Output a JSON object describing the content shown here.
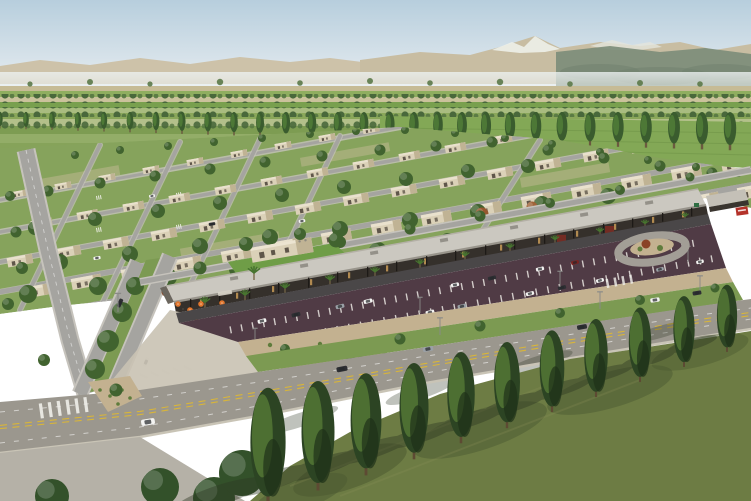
{
  "scene": {
    "type": "aerial-architectural-rendering",
    "description": "Aerial rendering of a master-planned desert community: rows of single-story beige homes with lawns and trees, a retail strip with flat canopy roof, orange cafe umbrellas and palm trees, an angled parking lot, a tree-lined boulevard, farmland strips, a poplar windbreak and mountains under a pale blue sky.",
    "regions": [
      "sky",
      "mountains",
      "farmland",
      "windbreak-poplars",
      "residential-area",
      "west-avenue",
      "retail-strip",
      "dining-plaza",
      "parking-lot",
      "landscape-median",
      "main-boulevard",
      "roundabout-island",
      "foreground-grass",
      "foreground-trees"
    ],
    "approximate_counts": {
      "houses": 62,
      "parked_cars": 19,
      "moving_cars": 10,
      "foreground_trees": 11,
      "windbreak_poplars": 29,
      "plaza_umbrellas": 6,
      "storefront_palms": 12
    }
  },
  "palette": {
    "skyTop": "#b7cedd",
    "skyHorizon": "#e9eef1",
    "mountain": "#cdc2a9",
    "mountainSnow": "#edefe9",
    "mountainRidge": "#7d8d7a",
    "fieldTan": "#c6bb95",
    "fieldGreen": "#8fae5f",
    "lawn": "#86a35c",
    "treeGreen": "#41632f",
    "treeHighlight": "#567b36",
    "poplarGreen": "#3a5c2e",
    "house": "#dbd1b8",
    "houseShade": "#c0b394",
    "houseDetail": "#5f564a",
    "road": "#a5a4a0",
    "roadCasing": "#c6c3bc",
    "boulevard": "#9b978e",
    "parkingLot": "#503b45",
    "asphalt": "#4a4748",
    "canopyRoof": "#cbc8c0",
    "storefront": "#35302b",
    "storefrontGlow": "#c79a57",
    "umbrella": "#e0762e",
    "medianGrass": "#7c9a52",
    "foregroundGrass": "#6d7c44",
    "foregroundTree": "#2c4423",
    "laneYellow": "#d8b53a",
    "carWhite": "#f4f4f2",
    "carDark": "#2e2f33",
    "carSilver": "#9aa0a6",
    "carRed": "#7c2320",
    "signRed": "#b4322a",
    "dirt": "#c3b190",
    "shrub": "#5f7c3c"
  }
}
